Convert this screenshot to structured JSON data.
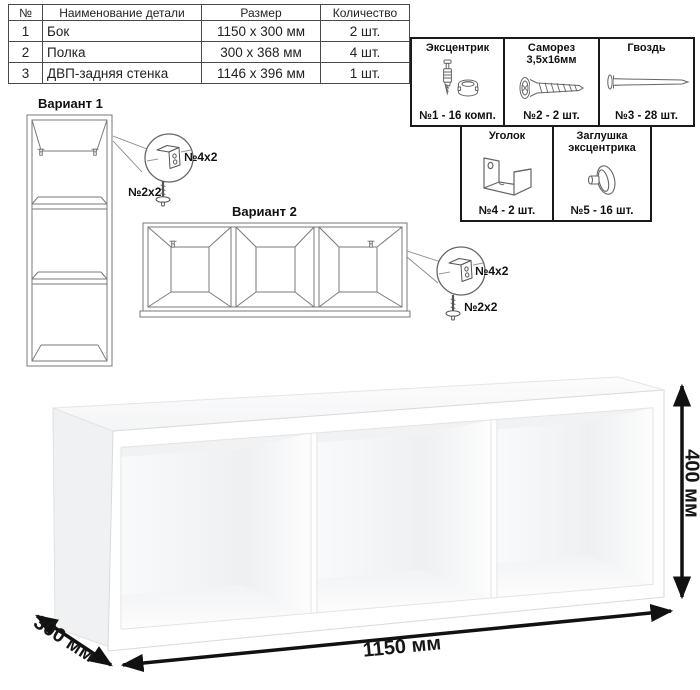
{
  "parts_table": {
    "headers": {
      "num": "№",
      "name": "Наименование детали",
      "size": "Размер",
      "qty": "Количество"
    },
    "rows": [
      {
        "num": "1",
        "name": "Бок",
        "size": "1150 x 300 мм",
        "qty": "2 шт."
      },
      {
        "num": "2",
        "name": "Полка",
        "size": "300 x 368 мм",
        "qty": "4 шт."
      },
      {
        "num": "3",
        "name": "ДВП-задняя стенка",
        "size": "1146 x 396 мм",
        "qty": "1 шт."
      }
    ]
  },
  "hardware": {
    "items": [
      {
        "title": "Эксцентрик",
        "qty": "№1 - 16 комп.",
        "icon": "cam-lock-icon"
      },
      {
        "title": "Саморез 3,5х16мм",
        "qty": "№2 - 2 шт.",
        "icon": "screw-icon"
      },
      {
        "title": "Гвоздь",
        "qty": "№3 - 28 шт.",
        "icon": "nail-icon"
      },
      {
        "title": "Уголок",
        "qty": "№4 - 2 шт.",
        "icon": "angle-bracket-icon"
      },
      {
        "title": "Заглушка эксцентрика",
        "qty": "№5 - 16 шт.",
        "icon": "cam-cap-icon"
      }
    ]
  },
  "variants": {
    "v1": {
      "title": "Вариант 1",
      "bracket_label": "№4х2",
      "screw_label": "№2х2"
    },
    "v2": {
      "title": "Вариант 2",
      "bracket_label": "№4х2",
      "screw_label": "№2х2"
    }
  },
  "dimensions": {
    "width": "1150 мм",
    "depth": "300 мм",
    "height": "400 мм"
  },
  "colors": {
    "line_art": "#7a7a7a",
    "dimension_arrow": "#111111",
    "hardware_border": "#1a1a1a",
    "table_border": "#4a4a4a"
  }
}
